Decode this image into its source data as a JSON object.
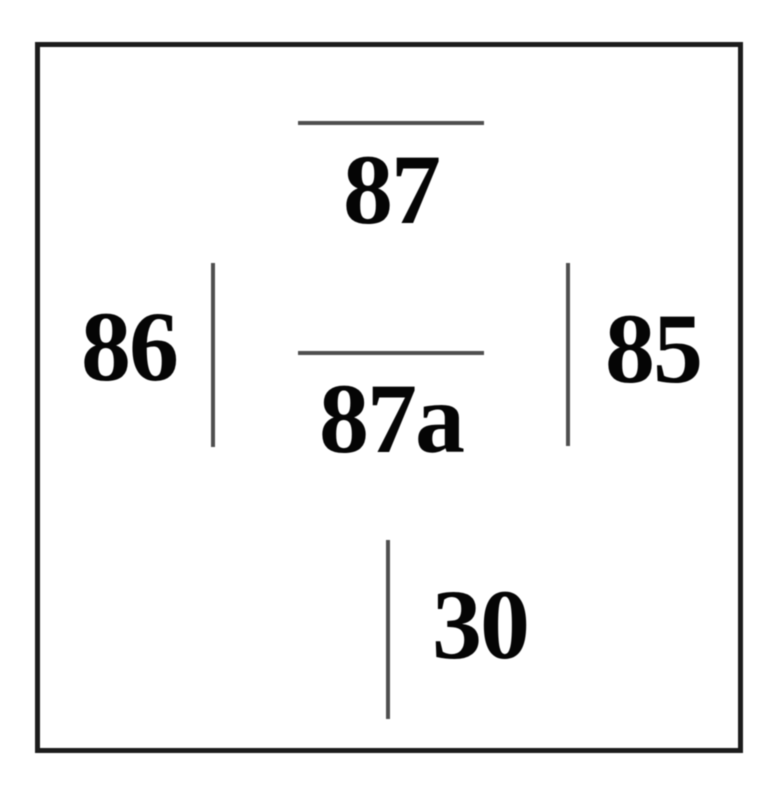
{
  "diagram": {
    "type": "relay-pin-diagram",
    "pins": [
      {
        "label": "87",
        "line": "horizontal-above",
        "position": "top-center"
      },
      {
        "label": "86",
        "line": "vertical-right",
        "position": "middle-left"
      },
      {
        "label": "85",
        "line": "vertical-left",
        "position": "middle-right"
      },
      {
        "label": "87a",
        "line": "horizontal-above",
        "position": "center"
      },
      {
        "label": "30",
        "line": "vertical-left",
        "position": "bottom-center"
      }
    ],
    "colors": {
      "background": "#ffffff",
      "outline": "#1c1c1c",
      "pin_line": "#4f4f4f",
      "label_text": "#050505"
    }
  }
}
